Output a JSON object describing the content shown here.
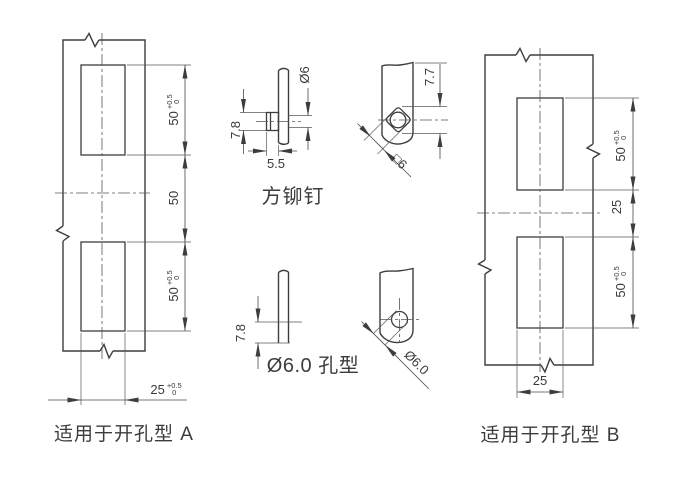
{
  "diagram": {
    "title_hint": "hinge mounting hole pattern drawing",
    "colors": {
      "outline": "#3d3d3d",
      "dimension": "#4a4a4a",
      "text": "#3a3a3a",
      "background": "#ffffff"
    },
    "plate_a": {
      "caption": "适用于开孔型 A",
      "dim_hole1": {
        "value": "50",
        "tol_plus": "+0.5",
        "tol_zero": "0"
      },
      "dim_gap": "50",
      "dim_hole2": {
        "value": "50",
        "tol_plus": "+0.5",
        "tol_zero": "0"
      },
      "dim_width": {
        "value": "25",
        "tol_plus": "+0.5",
        "tol_zero": "0"
      }
    },
    "rivet_side": {
      "caption": "方铆钉",
      "dim_head_height": "7.8",
      "dim_head_length": "5.5",
      "dim_shaft_dia": "Ø6"
    },
    "rivet_front": {
      "dim_corner": "7.7",
      "dim_square": "□6"
    },
    "hole_side": {
      "caption": "Ø6.0 孔型",
      "dim_height": "7.8"
    },
    "hole_front": {
      "dim_dia": "Ø6.0"
    },
    "plate_b": {
      "caption": "适用于开孔型 B",
      "dim_hole1": {
        "value": "50",
        "tol_plus": "+0.5",
        "tol_zero": "0"
      },
      "dim_gap": "25",
      "dim_hole2": {
        "value": "50",
        "tol_plus": "+0.5",
        "tol_zero": "0"
      },
      "dim_width": "25"
    }
  }
}
